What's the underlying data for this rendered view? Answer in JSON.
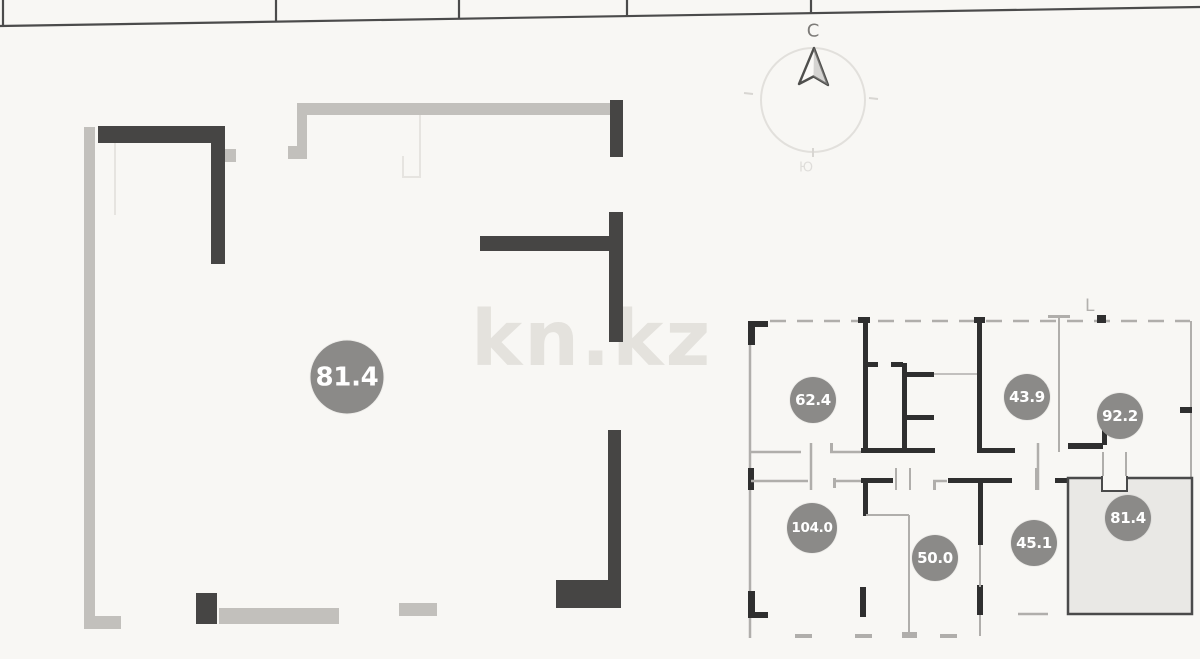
{
  "compass": {
    "north_label": "C",
    "south_label": "Ю"
  },
  "watermark": {
    "text": "kn.kz"
  },
  "grid_label": {
    "text": "L"
  },
  "main_plan": {
    "area_badge": "81.4"
  },
  "key_plan": {
    "highlighted_unit_area": "81.4",
    "units": [
      {
        "area": "62.4"
      },
      {
        "area": "43.9"
      },
      {
        "area": "92.2"
      },
      {
        "area": "104.0"
      },
      {
        "area": "50.0"
      },
      {
        "area": "45.1"
      },
      {
        "area": "81.4"
      }
    ]
  },
  "colors": {
    "background": "#f8f7f4",
    "wall_dark": "#464544",
    "wall_light": "#c2c0bc",
    "keyplan_black": "#2f2f2f",
    "keyplan_gray": "#b0aeab",
    "badge_fill": "#8b8a88",
    "badge_text": "#ffffff",
    "highlight_unit_fill": "#e9e8e5"
  }
}
